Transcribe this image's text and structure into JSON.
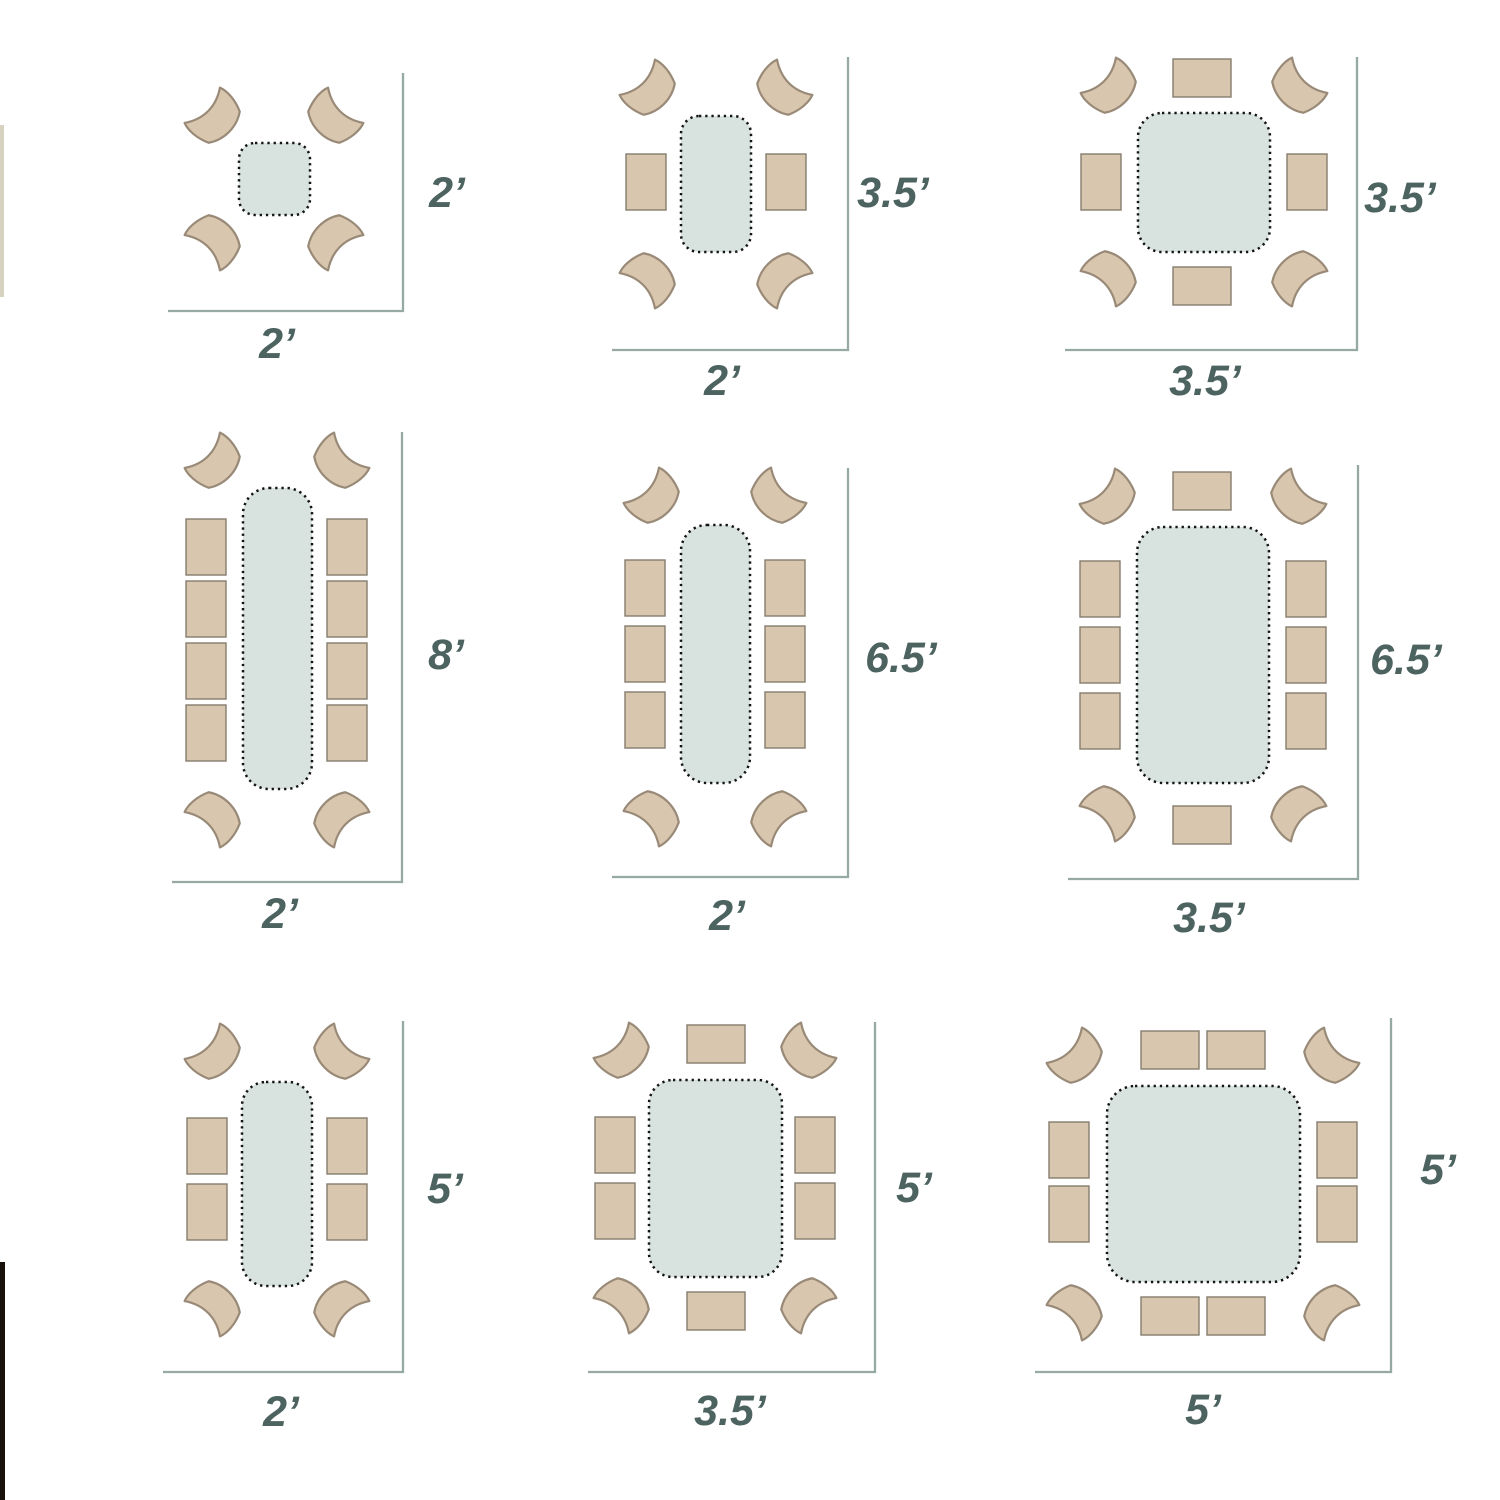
{
  "diagram": {
    "type": "dining-table-seating-plans",
    "colors": {
      "chair_fill": "#d9c6ae",
      "corner_chair_stroke": "#998a78",
      "side_chair_stroke": "#857c6e",
      "table_fill": "#d8e3e0",
      "table_dotted_stroke": "#141414",
      "dimension_line": "#97a9a5",
      "label_text": "#4c6360",
      "left_edge_strip_tan": "#d7d2c0",
      "left_edge_strip_dark": "#17100b"
    }
  },
  "layouts": [
    {
      "name": "table-2ft-x-2ft",
      "width_label": "2’",
      "height_label": "2’",
      "seats": {
        "corner": 4,
        "left": 0,
        "right": 0,
        "top": 0,
        "bottom": 0,
        "total": 4
      }
    },
    {
      "name": "table-2ft-x-3_5ft",
      "width_label": "2’",
      "height_label": "3.5’",
      "seats": {
        "corner": 4,
        "left": 1,
        "right": 1,
        "top": 0,
        "bottom": 0,
        "total": 6
      }
    },
    {
      "name": "table-3_5ft-x-3_5ft",
      "width_label": "3.5’",
      "height_label": "3.5’",
      "seats": {
        "corner": 4,
        "left": 1,
        "right": 1,
        "top": 1,
        "bottom": 1,
        "total": 8
      }
    },
    {
      "name": "table-2ft-x-8ft",
      "width_label": "2’",
      "height_label": "8’",
      "seats": {
        "corner": 4,
        "left": 4,
        "right": 4,
        "top": 0,
        "bottom": 0,
        "total": 12
      }
    },
    {
      "name": "table-2ft-x-6_5ft",
      "width_label": "2’",
      "height_label": "6.5’",
      "seats": {
        "corner": 4,
        "left": 3,
        "right": 3,
        "top": 0,
        "bottom": 0,
        "total": 10
      }
    },
    {
      "name": "table-3_5ft-x-6_5ft",
      "width_label": "3.5’",
      "height_label": "6.5’",
      "seats": {
        "corner": 4,
        "left": 3,
        "right": 3,
        "top": 1,
        "bottom": 1,
        "total": 12
      }
    },
    {
      "name": "table-2ft-x-5ft",
      "width_label": "2’",
      "height_label": "5’",
      "seats": {
        "corner": 4,
        "left": 2,
        "right": 2,
        "top": 0,
        "bottom": 0,
        "total": 8
      }
    },
    {
      "name": "table-3_5ft-x-5ft",
      "width_label": "3.5’",
      "height_label": "5’",
      "seats": {
        "corner": 4,
        "left": 2,
        "right": 2,
        "top": 1,
        "bottom": 1,
        "total": 10
      }
    },
    {
      "name": "table-5ft-x-5ft",
      "width_label": "5’",
      "height_label": "5’",
      "seats": {
        "corner": 4,
        "left": 2,
        "right": 2,
        "top": 2,
        "bottom": 2,
        "total": 12
      }
    }
  ]
}
